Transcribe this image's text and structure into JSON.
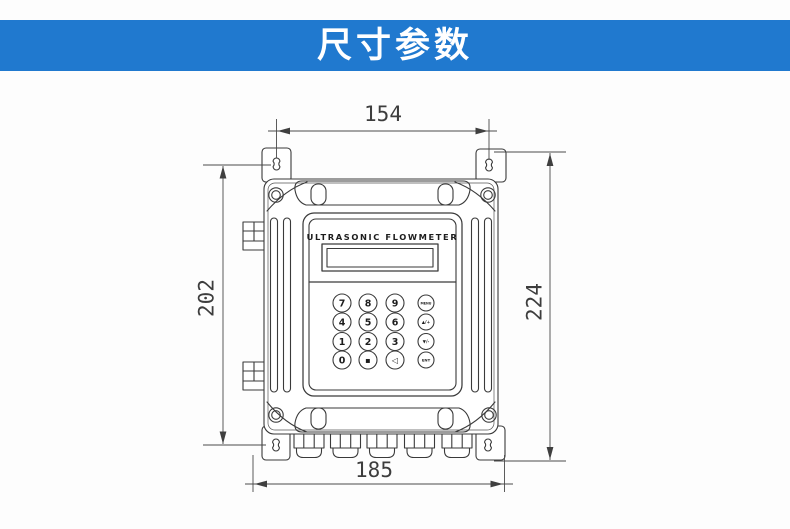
{
  "header": {
    "title": "尺寸参数",
    "bg_color": "#2079cf",
    "text_color": "#ffffff"
  },
  "drawing": {
    "device_label": "ULTRASONIC FLOWMETER",
    "dimensions": {
      "top_width": "154",
      "left_height": "202",
      "right_height": "224",
      "bottom_width": "185"
    },
    "keypad": {
      "rows": [
        {
          "keys": [
            "7",
            "8",
            "9",
            "MENU"
          ]
        },
        {
          "keys": [
            "4",
            "5",
            "6",
            "▲/+"
          ]
        },
        {
          "keys": [
            "1",
            "2",
            "3",
            "▼/-"
          ]
        },
        {
          "keys": [
            "0",
            "▪",
            "◁",
            "ENT"
          ]
        }
      ]
    },
    "line_color": "#3a3a3a"
  }
}
